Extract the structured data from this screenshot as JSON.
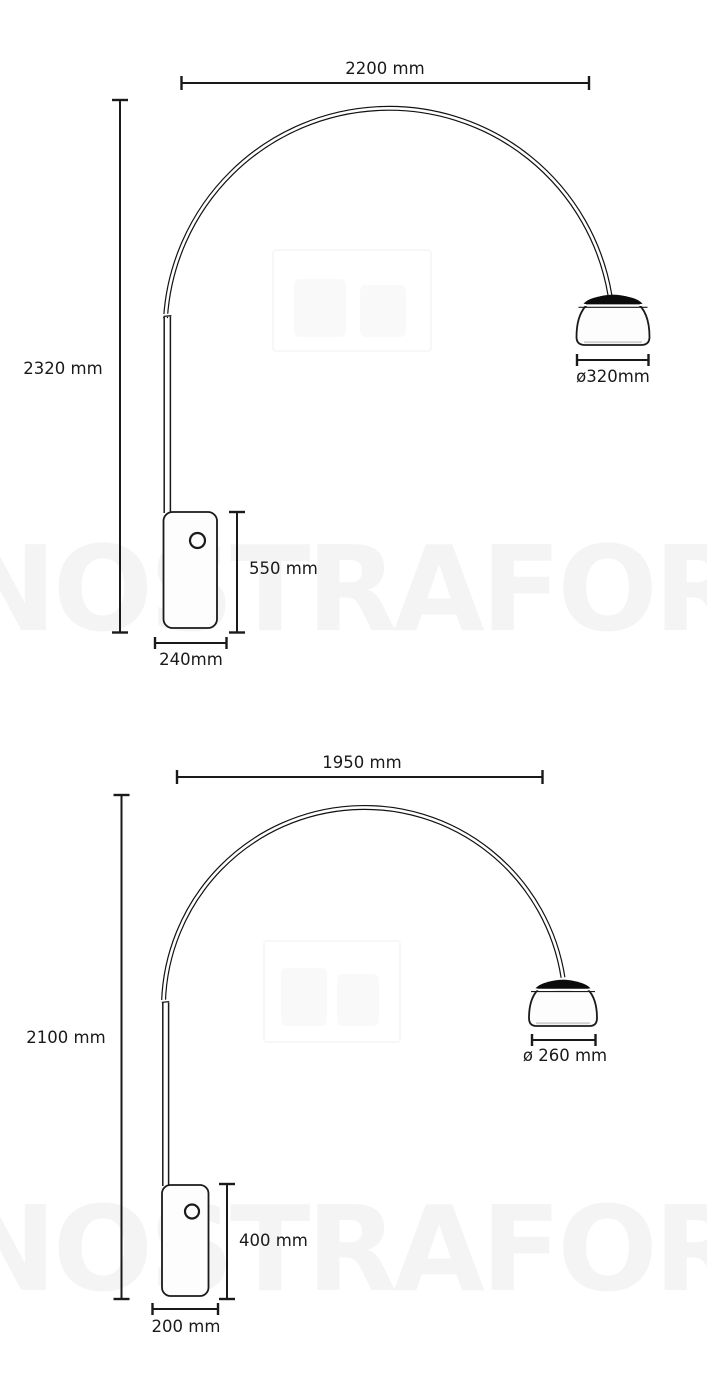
{
  "colors": {
    "background": "#ffffff",
    "line": "#1a1a1a",
    "shade_cap": "#0b0b0b",
    "watermark": "rgba(0,0,0,0.045)"
  },
  "watermark": {
    "text": "NOSTRAFORMA"
  },
  "diagrams": [
    {
      "id": "arco-lamp-large",
      "arc_span": {
        "value_mm": 2200,
        "label": "2200 mm"
      },
      "total_height": {
        "value_mm": 2320,
        "label": "2320 mm"
      },
      "shade_diameter": {
        "value_mm": 320,
        "label": "ø320mm"
      },
      "base_height": {
        "value_mm": 550,
        "label": "550 mm"
      },
      "base_width": {
        "value_mm": 240,
        "label": "240mm"
      }
    },
    {
      "id": "arco-lamp-small",
      "arc_span": {
        "value_mm": 1950,
        "label": "1950 mm"
      },
      "total_height": {
        "value_mm": 2100,
        "label": "2100 mm"
      },
      "shade_diameter": {
        "value_mm": 260,
        "label": "ø 260 mm"
      },
      "base_height": {
        "value_mm": 400,
        "label": "400 mm"
      },
      "base_width": {
        "value_mm": 200,
        "label": "200 mm"
      }
    }
  ]
}
